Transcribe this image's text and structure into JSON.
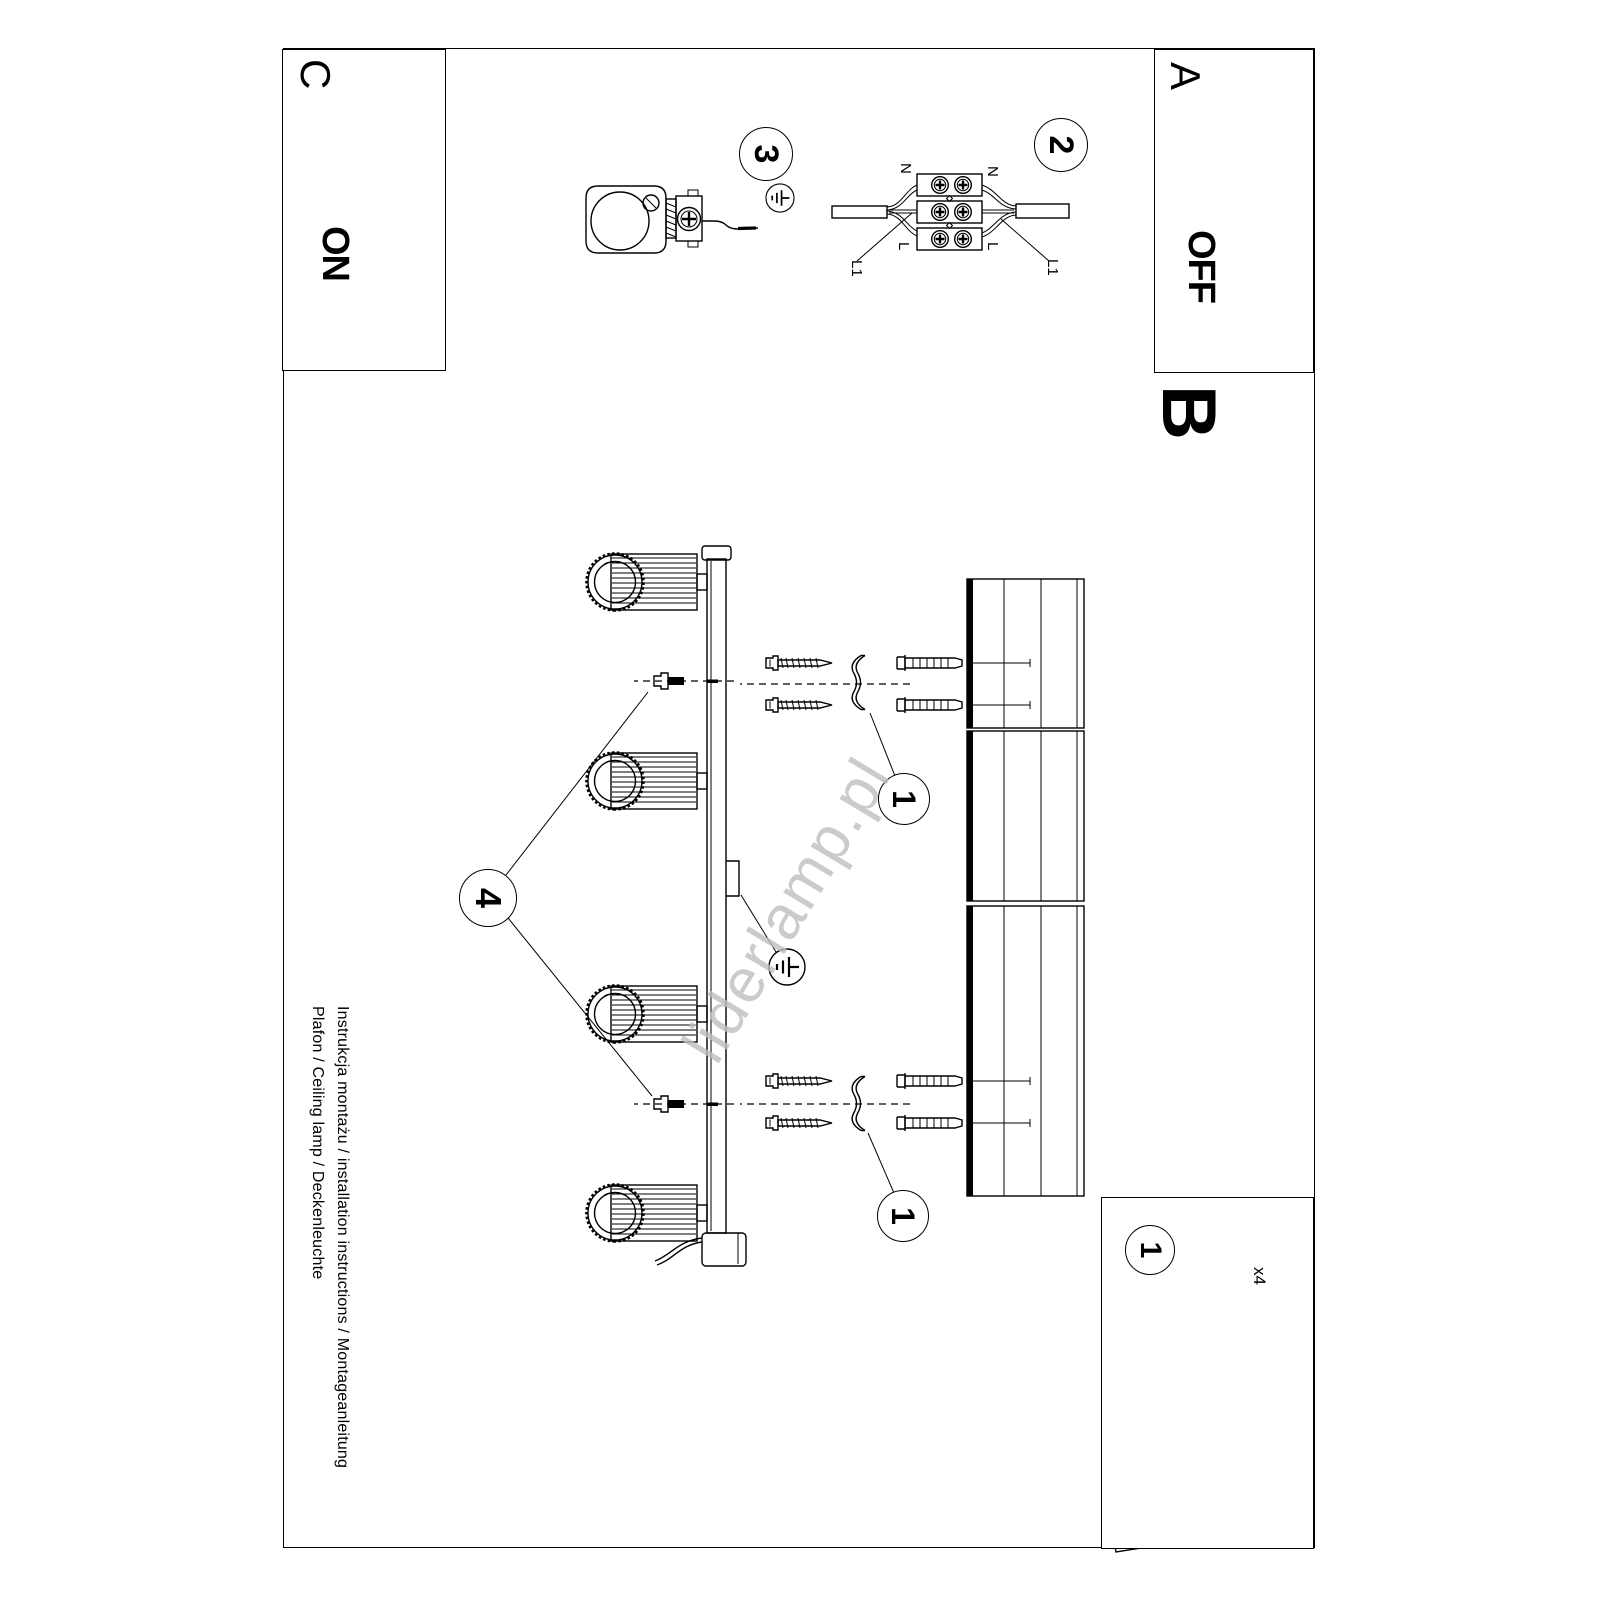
{
  "sections": {
    "a": "A",
    "b": "B",
    "c": "C"
  },
  "power": {
    "on": "ON",
    "off": "OFF"
  },
  "steps": {
    "one": "1",
    "two": "2",
    "three": "3",
    "four": "4"
  },
  "wiring_labels": {
    "neutral": "N",
    "line": "L",
    "line1": "L1"
  },
  "parts": {
    "screws_qty": "x4"
  },
  "footer": {
    "line1": "Instrukcja montażu / installation instructions / Montageanleitung",
    "line2": "Plafon / Ceiling lamp / Deckenleuchte"
  },
  "watermark": "liderlamp.pl"
}
